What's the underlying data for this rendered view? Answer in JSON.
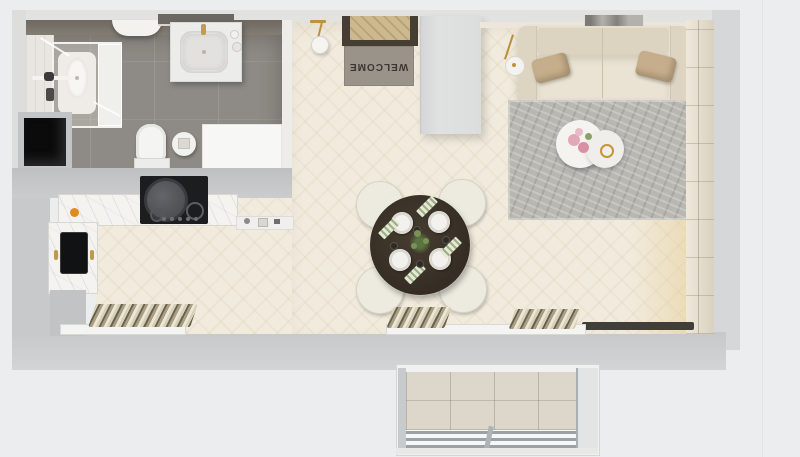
{
  "floorplan": {
    "title": "studio-apartment-top-view-render",
    "welcome_mat": {
      "text": "WELCOME"
    },
    "rooms": [
      {
        "name": "bathroom"
      },
      {
        "name": "kitchen"
      },
      {
        "name": "entry-hall"
      },
      {
        "name": "living-dining-room"
      },
      {
        "name": "balcony"
      }
    ],
    "furniture": [
      "shower-enclosure",
      "vanity-sink",
      "toilet",
      "bath-mat",
      "storage-niche",
      "towel-shelf",
      "kitchen-counter",
      "cooktop-with-pot",
      "kitchen-sink",
      "entry-door",
      "welcome-mat",
      "wardrobe",
      "pendant-lamp",
      "sofa",
      "throw-pillows",
      "wall-art",
      "floor-lamp",
      "rug",
      "coffee-table",
      "flower-bouquet",
      "dining-table",
      "dining-chairs",
      "place-settings",
      "centerpiece-plant",
      "radiators",
      "window-sills",
      "balcony-railing"
    ],
    "colors": {
      "background": "#ecedee",
      "wall": "#c9cacb",
      "wood_floor": "#f1ebdd",
      "wood_floor_warm": "#e6ce96",
      "bathroom_tile": "#8e8a85",
      "marble_counter": "#f5f3f0",
      "sofa": "#e5decd",
      "pillow": "#c6ae8c",
      "rug": "#b9b7b2",
      "dining_table": "#383027",
      "door_frame": "#473e33",
      "welcome_mat": "#99938a",
      "accent_gold": "#bd9240",
      "sink_black": "#111214",
      "balcony_tile": "#dcd7ca"
    }
  }
}
